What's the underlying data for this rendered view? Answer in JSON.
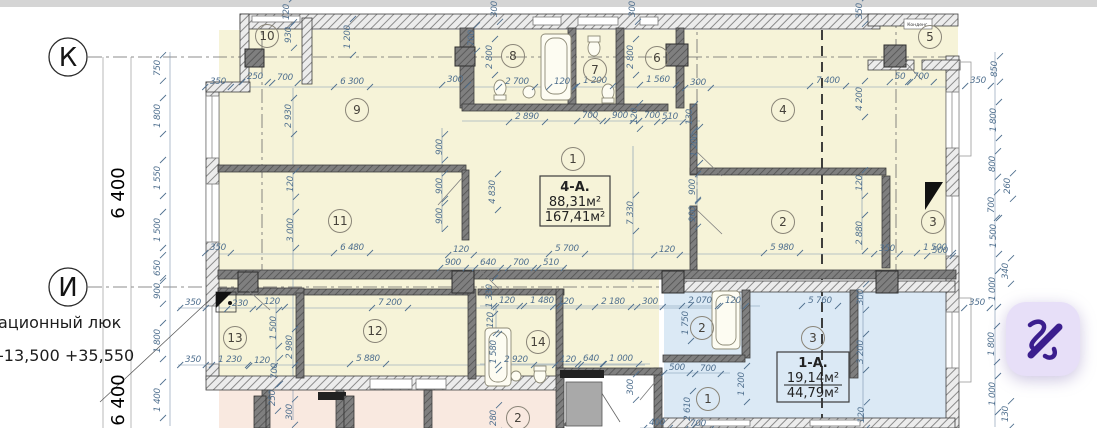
{
  "plan": {
    "axis_rows": [
      {
        "label": "К"
      },
      {
        "label": "И"
      }
    ],
    "left_margin": {
      "hatch_note": "ационный люк",
      "elevation_note": "-13,500 +35,550",
      "axis_span_1": "6 400",
      "axis_span_2": "6 400"
    },
    "apartments": [
      {
        "id": "4-А.",
        "area_living": "88,31м²",
        "area_total": "167,41м²"
      },
      {
        "id": "1-А.",
        "area_living": "19,14м²",
        "area_total": "44,79м²"
      }
    ],
    "unit_note": "Конденс.",
    "rooms": [
      {
        "n": "10",
        "x": 267,
        "y": 36
      },
      {
        "n": "8",
        "x": 513,
        "y": 56
      },
      {
        "n": "7",
        "x": 595,
        "y": 70
      },
      {
        "n": "6",
        "x": 657,
        "y": 58
      },
      {
        "n": "5",
        "x": 930,
        "y": 37
      },
      {
        "n": "9",
        "x": 357,
        "y": 110
      },
      {
        "n": "4",
        "x": 783,
        "y": 110
      },
      {
        "n": "1",
        "x": 573,
        "y": 159
      },
      {
        "n": "11",
        "x": 340,
        "y": 221
      },
      {
        "n": "2",
        "x": 783,
        "y": 222
      },
      {
        "n": "3",
        "x": 933,
        "y": 222
      },
      {
        "n": "12",
        "x": 375,
        "y": 331
      },
      {
        "n": "13",
        "x": 235,
        "y": 338
      },
      {
        "n": "14",
        "x": 538,
        "y": 342
      },
      {
        "n": "2",
        "x": 702,
        "y": 328
      },
      {
        "n": "3",
        "x": 813,
        "y": 338
      },
      {
        "n": "1",
        "x": 708,
        "y": 399
      },
      {
        "n": "2",
        "x": 518,
        "y": 418
      }
    ],
    "dimensions": [
      {
        "t": "750",
        "x": 160,
        "y": 68,
        "v": 1
      },
      {
        "t": "1 800",
        "x": 160,
        "y": 116,
        "v": 1
      },
      {
        "t": "1 550",
        "x": 160,
        "y": 178,
        "v": 1
      },
      {
        "t": "1 500",
        "x": 160,
        "y": 230,
        "v": 1
      },
      {
        "t": "650",
        "x": 160,
        "y": 268,
        "v": 1
      },
      {
        "t": "900",
        "x": 160,
        "y": 291,
        "v": 1
      },
      {
        "t": "1 800",
        "x": 160,
        "y": 341,
        "v": 1
      },
      {
        "t": "1 400",
        "x": 160,
        "y": 400,
        "v": 1
      },
      {
        "t": "350",
        "x": 218,
        "y": 84
      },
      {
        "t": "250",
        "x": 255,
        "y": 79
      },
      {
        "t": "700",
        "x": 285,
        "y": 80
      },
      {
        "t": "6 300",
        "x": 352,
        "y": 84
      },
      {
        "t": "300",
        "x": 455,
        "y": 82
      },
      {
        "t": "2 700",
        "x": 517,
        "y": 84
      },
      {
        "t": "120",
        "x": 289,
        "y": 12,
        "v": 1
      },
      {
        "t": "930",
        "x": 291,
        "y": 35,
        "v": 1
      },
      {
        "t": "1 200",
        "x": 350,
        "y": 37,
        "v": 1
      },
      {
        "t": "700",
        "x": 474,
        "y": 38,
        "v": 1
      },
      {
        "t": "300",
        "x": 497,
        "y": 9,
        "v": 1
      },
      {
        "t": "300",
        "x": 635,
        "y": 9,
        "v": 1
      },
      {
        "t": "350",
        "x": 862,
        "y": 11,
        "v": 1
      },
      {
        "t": "2 800",
        "x": 492,
        "y": 57,
        "v": 1
      },
      {
        "t": "2 800",
        "x": 633,
        "y": 57,
        "v": 1
      },
      {
        "t": "120",
        "x": 562,
        "y": 84
      },
      {
        "t": "1 200",
        "x": 595,
        "y": 83
      },
      {
        "t": "1 560",
        "x": 658,
        "y": 82
      },
      {
        "t": "300",
        "x": 698,
        "y": 85
      },
      {
        "t": "2 890",
        "x": 527,
        "y": 119
      },
      {
        "t": "700",
        "x": 590,
        "y": 118
      },
      {
        "t": "900",
        "x": 620,
        "y": 118
      },
      {
        "t": "120",
        "x": 637,
        "y": 116,
        "v": 1
      },
      {
        "t": "700",
        "x": 652,
        "y": 118
      },
      {
        "t": "510",
        "x": 670,
        "y": 119
      },
      {
        "t": "130",
        "x": 692,
        "y": 117,
        "v": 1
      },
      {
        "t": "7 400",
        "x": 828,
        "y": 83
      },
      {
        "t": "50",
        "x": 900,
        "y": 79
      },
      {
        "t": "700",
        "x": 921,
        "y": 79
      },
      {
        "t": "350",
        "x": 978,
        "y": 83
      },
      {
        "t": "4 200",
        "x": 862,
        "y": 99,
        "v": 1
      },
      {
        "t": "850",
        "x": 997,
        "y": 69,
        "v": 1
      },
      {
        "t": "1 800",
        "x": 996,
        "y": 120,
        "v": 1
      },
      {
        "t": "800",
        "x": 995,
        "y": 164,
        "v": 1
      },
      {
        "t": "260",
        "x": 1010,
        "y": 186,
        "v": 1
      },
      {
        "t": "700",
        "x": 994,
        "y": 205,
        "v": 1
      },
      {
        "t": "1 500",
        "x": 996,
        "y": 236,
        "v": 1
      },
      {
        "t": "340",
        "x": 1008,
        "y": 271,
        "v": 1
      },
      {
        "t": "1 000",
        "x": 995,
        "y": 289,
        "v": 1
      },
      {
        "t": "350",
        "x": 977,
        "y": 305
      },
      {
        "t": "1 800",
        "x": 994,
        "y": 344,
        "v": 1
      },
      {
        "t": "1 000",
        "x": 995,
        "y": 394,
        "v": 1
      },
      {
        "t": "130",
        "x": 1008,
        "y": 414,
        "v": 1
      },
      {
        "t": "500",
        "x": 940,
        "y": 253
      },
      {
        "t": "2 930",
        "x": 291,
        "y": 116,
        "v": 1
      },
      {
        "t": "120",
        "x": 293,
        "y": 184,
        "v": 1
      },
      {
        "t": "3 000",
        "x": 293,
        "y": 230,
        "v": 1
      },
      {
        "t": "350",
        "x": 218,
        "y": 250
      },
      {
        "t": "6 480",
        "x": 352,
        "y": 250
      },
      {
        "t": "120",
        "x": 461,
        "y": 252
      },
      {
        "t": "900",
        "x": 442,
        "y": 147,
        "v": 1
      },
      {
        "t": "900",
        "x": 442,
        "y": 186,
        "v": 1
      },
      {
        "t": "900",
        "x": 442,
        "y": 216,
        "v": 1
      },
      {
        "t": "4 830",
        "x": 495,
        "y": 192,
        "v": 1
      },
      {
        "t": "7 330",
        "x": 633,
        "y": 213,
        "v": 1
      },
      {
        "t": "1 200",
        "x": 697,
        "y": 145,
        "v": 1
      },
      {
        "t": "900",
        "x": 695,
        "y": 187,
        "v": 1
      },
      {
        "t": "900",
        "x": 695,
        "y": 214,
        "v": 1
      },
      {
        "t": "5 700",
        "x": 567,
        "y": 251
      },
      {
        "t": "120",
        "x": 667,
        "y": 252
      },
      {
        "t": "900",
        "x": 453,
        "y": 265
      },
      {
        "t": "640",
        "x": 488,
        "y": 265
      },
      {
        "t": "700",
        "x": 521,
        "y": 265
      },
      {
        "t": "510",
        "x": 551,
        "y": 265
      },
      {
        "t": "120",
        "x": 862,
        "y": 183,
        "v": 1
      },
      {
        "t": "2 880",
        "x": 862,
        "y": 233,
        "v": 1
      },
      {
        "t": "5 980",
        "x": 782,
        "y": 250
      },
      {
        "t": "350",
        "x": 887,
        "y": 251
      },
      {
        "t": "1 500",
        "x": 935,
        "y": 250
      },
      {
        "t": "350",
        "x": 193,
        "y": 305
      },
      {
        "t": "230",
        "x": 240,
        "y": 306
      },
      {
        "t": "120",
        "x": 272,
        "y": 304
      },
      {
        "t": "1 500",
        "x": 276,
        "y": 328,
        "v": 1
      },
      {
        "t": "350",
        "x": 193,
        "y": 362
      },
      {
        "t": "1 230",
        "x": 230,
        "y": 362
      },
      {
        "t": "120",
        "x": 262,
        "y": 363
      },
      {
        "t": "7 200",
        "x": 390,
        "y": 305
      },
      {
        "t": "2 980",
        "x": 292,
        "y": 347,
        "v": 1
      },
      {
        "t": "5 880",
        "x": 368,
        "y": 361
      },
      {
        "t": "700",
        "x": 277,
        "y": 371,
        "v": 1
      },
      {
        "t": "250",
        "x": 275,
        "y": 398,
        "v": 1
      },
      {
        "t": "300",
        "x": 292,
        "y": 412,
        "v": 1
      },
      {
        "t": "1 330",
        "x": 492,
        "y": 296,
        "v": 1
      },
      {
        "t": "120",
        "x": 507,
        "y": 303
      },
      {
        "t": "1 480",
        "x": 542,
        "y": 303
      },
      {
        "t": "120",
        "x": 566,
        "y": 304
      },
      {
        "t": "2 180",
        "x": 613,
        "y": 304
      },
      {
        "t": "300",
        "x": 650,
        "y": 304
      },
      {
        "t": "2 070",
        "x": 700,
        "y": 303
      },
      {
        "t": "120",
        "x": 733,
        "y": 303
      },
      {
        "t": "120",
        "x": 493,
        "y": 320,
        "v": 1
      },
      {
        "t": "1 750",
        "x": 688,
        "y": 323,
        "v": 1
      },
      {
        "t": "1 580",
        "x": 496,
        "y": 352,
        "v": 1
      },
      {
        "t": "2 920",
        "x": 516,
        "y": 362
      },
      {
        "t": "120",
        "x": 568,
        "y": 362
      },
      {
        "t": "640",
        "x": 591,
        "y": 361
      },
      {
        "t": "1 000",
        "x": 621,
        "y": 361
      },
      {
        "t": "300",
        "x": 633,
        "y": 387,
        "v": 1
      },
      {
        "t": "500",
        "x": 677,
        "y": 370
      },
      {
        "t": "700",
        "x": 708,
        "y": 371
      },
      {
        "t": "2 610",
        "x": 690,
        "y": 409,
        "v": 1
      },
      {
        "t": "1 200",
        "x": 744,
        "y": 384,
        "v": 1
      },
      {
        "t": "400",
        "x": 657,
        "y": 425
      },
      {
        "t": "700",
        "x": 698,
        "y": 426
      },
      {
        "t": "280",
        "x": 496,
        "y": 418,
        "v": 1
      },
      {
        "t": "5 760",
        "x": 820,
        "y": 303
      },
      {
        "t": "300",
        "x": 863,
        "y": 297,
        "v": 1
      },
      {
        "t": "3 200",
        "x": 863,
        "y": 352,
        "v": 1
      },
      {
        "t": "120",
        "x": 864,
        "y": 415,
        "v": 1
      }
    ],
    "colors": {
      "room_cream": "#f6f3d8",
      "apartment_blue": "#dbe9f5",
      "room_pink": "#f9e9e0",
      "dim_text": "#50708f",
      "wall": "#5c5c5c",
      "fab_bg": "#e7dff8",
      "fab_icon": "#3b1e8e"
    }
  }
}
